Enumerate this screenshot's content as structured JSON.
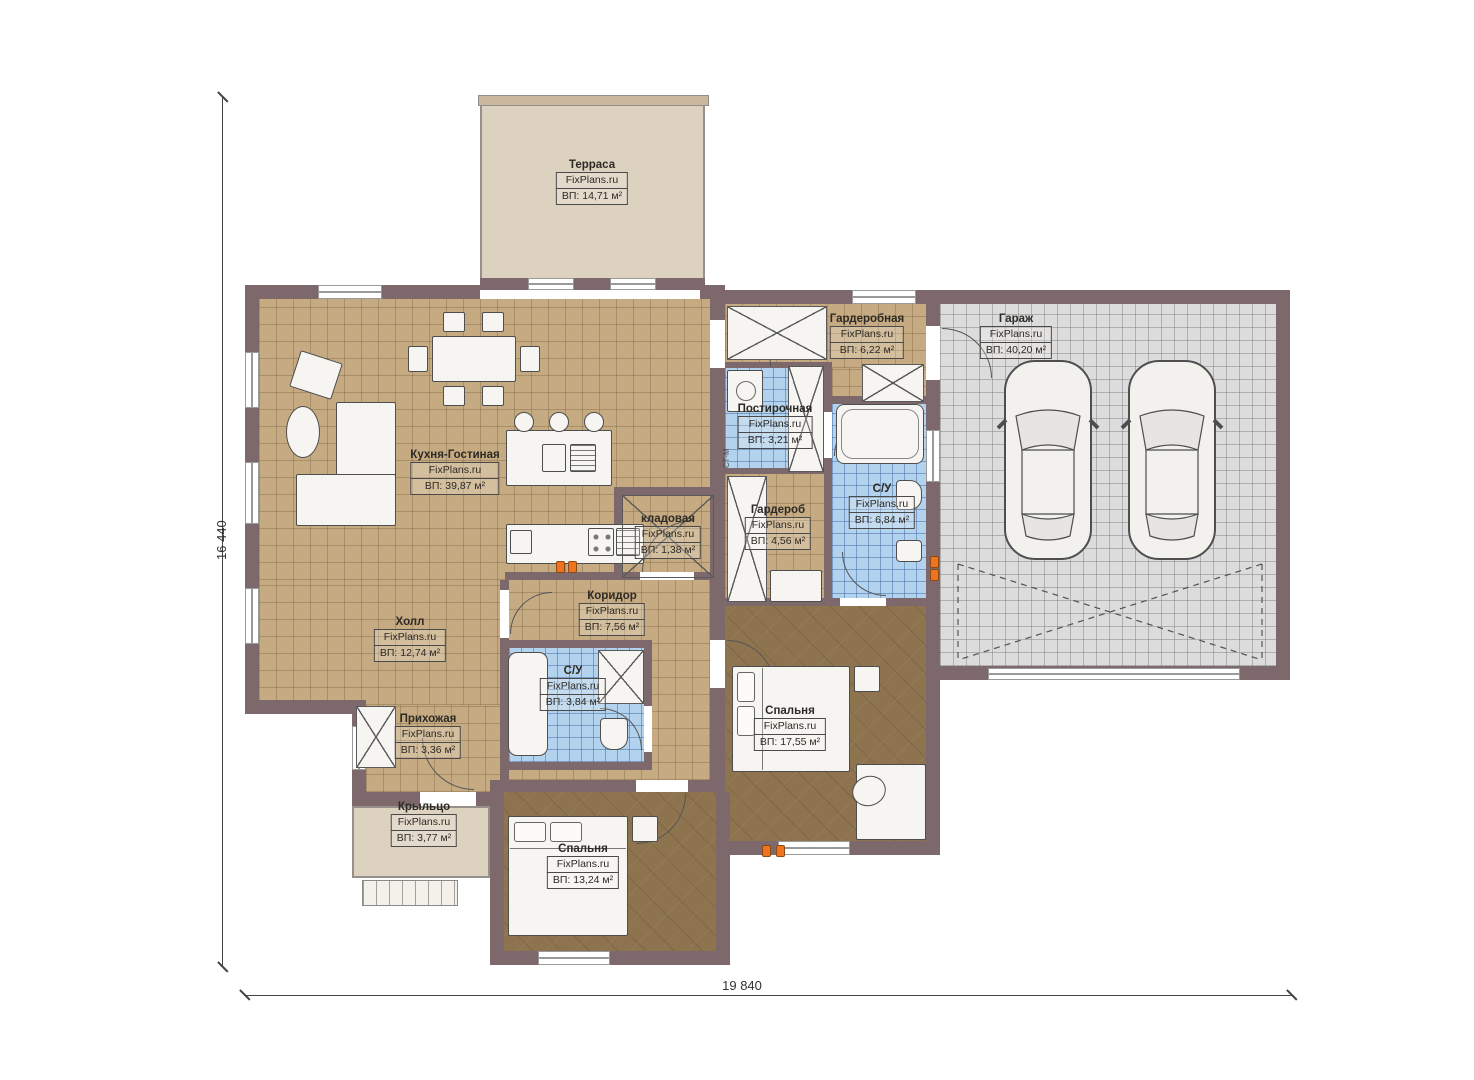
{
  "plan": {
    "dimensions": {
      "height": "16 440",
      "width": "19 840"
    },
    "washer_tag": "СТ-М",
    "rooms": [
      {
        "id": "terrace",
        "name": "Терраса",
        "brand": "FixPlans.ru",
        "area": "ВП: 14,71 м²"
      },
      {
        "id": "kitchen-living",
        "name": "Кухня-Гостиная",
        "brand": "FixPlans.ru",
        "area": "ВП: 39,87 м²"
      },
      {
        "id": "dressing-room",
        "name": "Гардеробная",
        "brand": "FixPlans.ru",
        "area": "ВП: 6,22 м²"
      },
      {
        "id": "garage",
        "name": "Гараж",
        "brand": "FixPlans.ru",
        "area": "ВП: 40,20 м²"
      },
      {
        "id": "laundry",
        "name": "Постирочная",
        "brand": "FixPlans.ru",
        "area": "ВП: 3,21 м²"
      },
      {
        "id": "bathroom-main",
        "name": "С/У",
        "brand": "FixPlans.ru",
        "area": "ВП: 6,84 м²"
      },
      {
        "id": "wardrobe",
        "name": "Гардероб",
        "brand": "FixPlans.ru",
        "area": "ВП: 4,56 м²"
      },
      {
        "id": "storage",
        "name": "кладовая",
        "brand": "FixPlans.ru",
        "area": "ВП: 1,38 м²"
      },
      {
        "id": "corridor",
        "name": "Коридор",
        "brand": "FixPlans.ru",
        "area": "ВП: 7,56 м²"
      },
      {
        "id": "hall",
        "name": "Холл",
        "brand": "FixPlans.ru",
        "area": "ВП: 12,74 м²"
      },
      {
        "id": "bathroom-small",
        "name": "С/У",
        "brand": "FixPlans.ru",
        "area": "ВП: 3,84 м²"
      },
      {
        "id": "entry",
        "name": "Прихожая",
        "brand": "FixPlans.ru",
        "area": "ВП: 3,36 м²"
      },
      {
        "id": "bedroom-right",
        "name": "Спальня",
        "brand": "FixPlans.ru",
        "area": "ВП: 17,55 м²"
      },
      {
        "id": "porch",
        "name": "Крыльцо",
        "brand": "FixPlans.ru",
        "area": "ВП: 3,77 м²"
      },
      {
        "id": "bedroom-bottom",
        "name": "Спальня",
        "brand": "FixPlans.ru",
        "area": "ВП: 13,24 м²"
      }
    ],
    "colors": {
      "wall": "#7d686c",
      "tile_tan": "#c6ab82",
      "tile_blue": "#b3d2ee",
      "tile_gray": "#dcdcdc",
      "wood": "#8d734e",
      "terrace": "#ddd1bf",
      "socket_accent": "#ee7420"
    }
  }
}
